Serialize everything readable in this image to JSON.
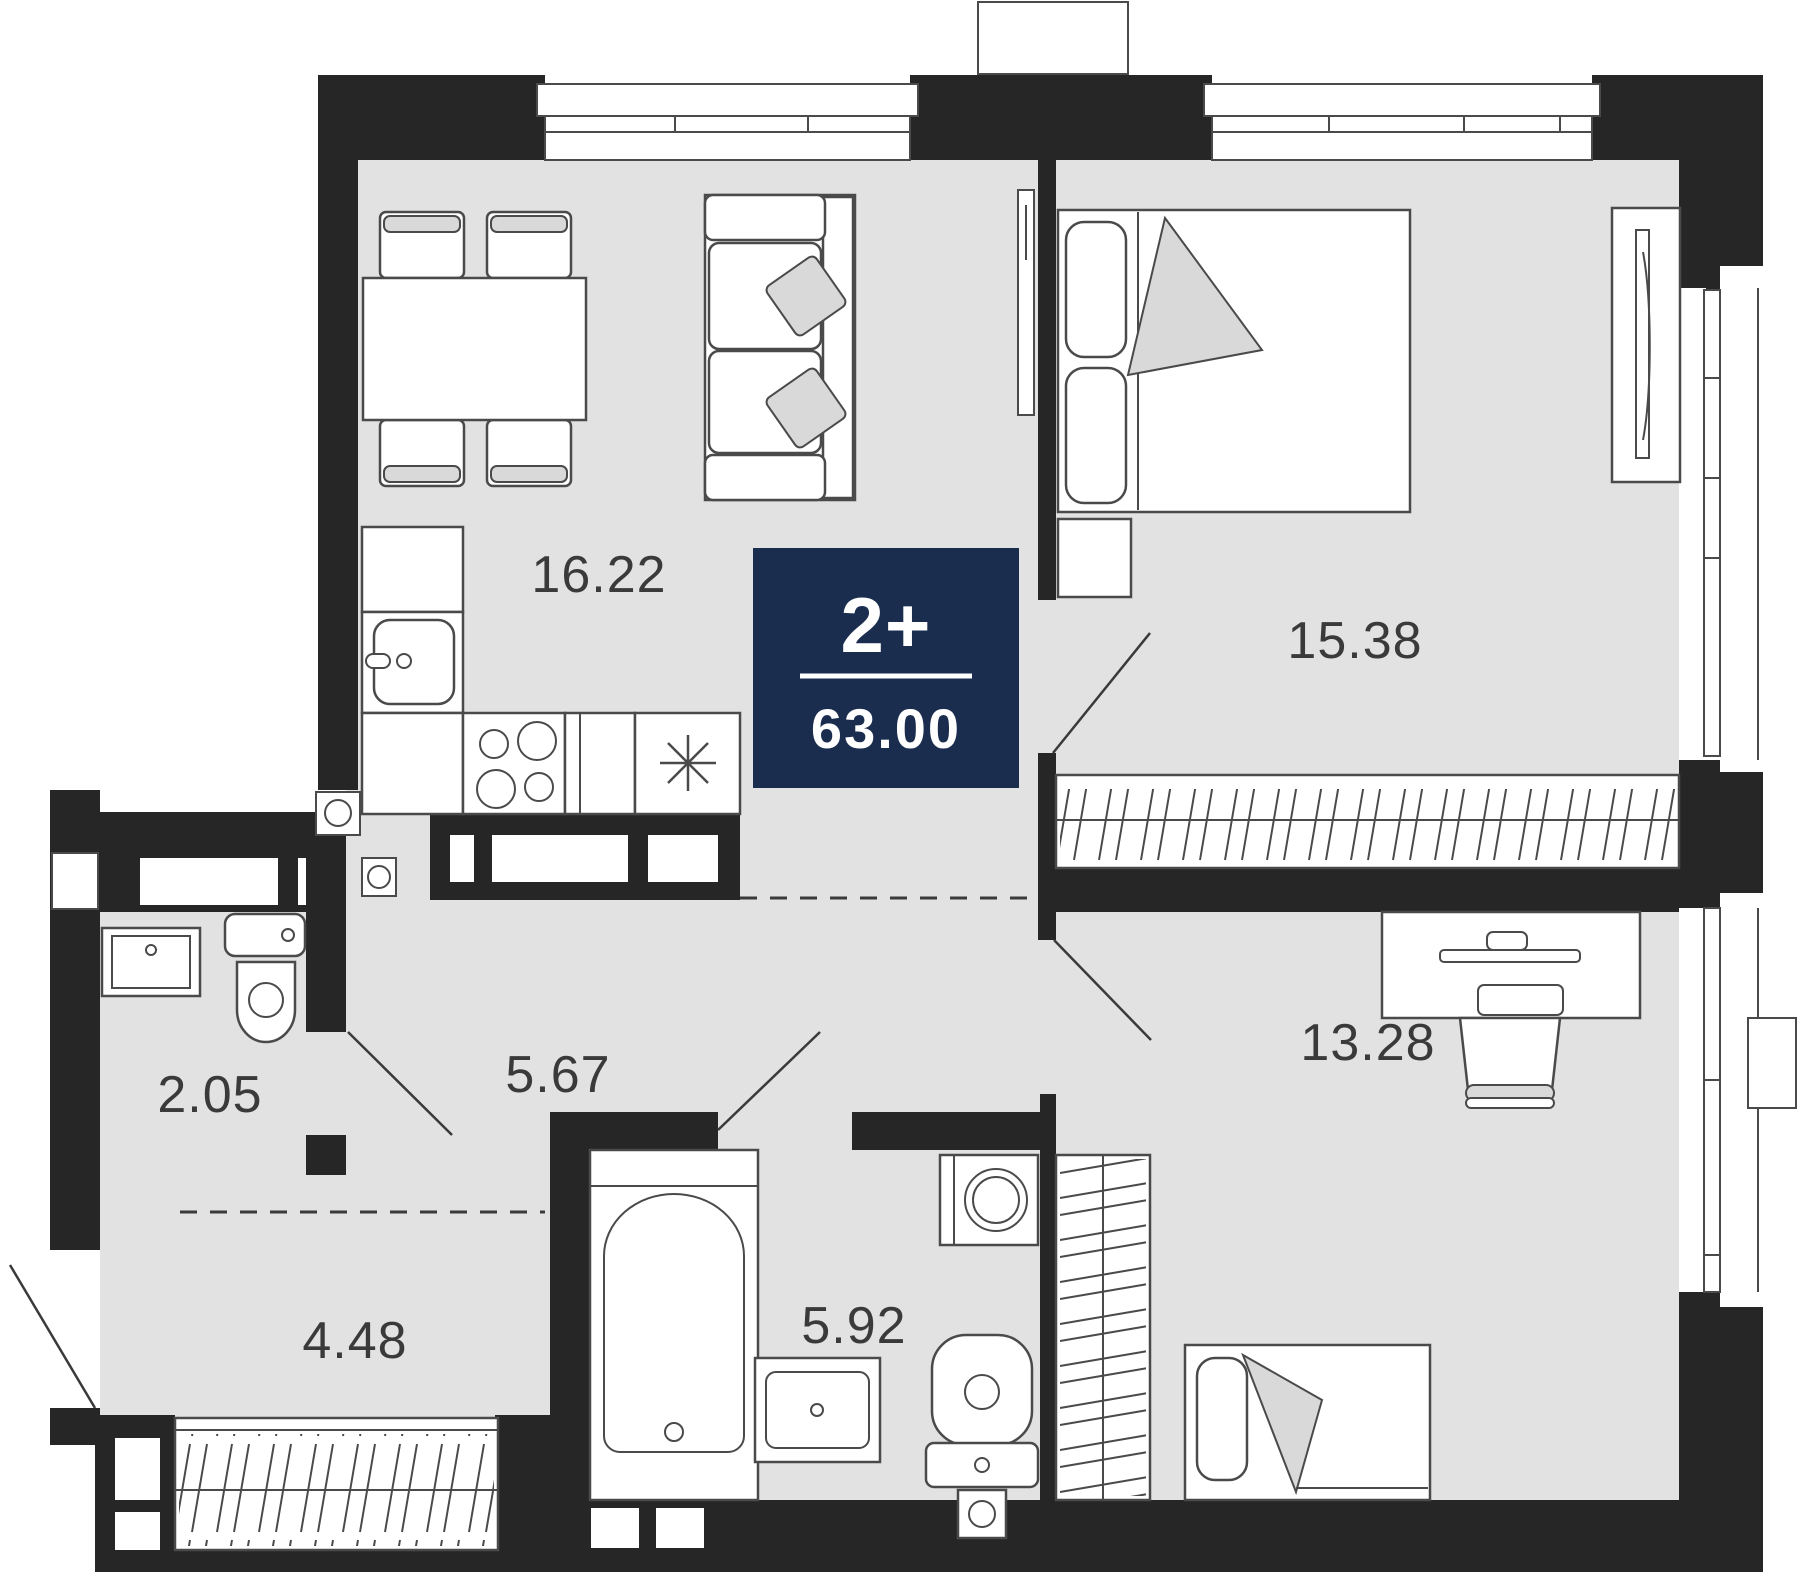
{
  "plan": {
    "title": "apartment-floor-plan",
    "badge": {
      "rooms_label": "2+",
      "total_area": "63.00",
      "background": "#1b2d4e",
      "text_color": "#ffffff"
    },
    "rooms": [
      {
        "id": "living-kitchen",
        "area": "16.22"
      },
      {
        "id": "bedroom",
        "area": "15.38"
      },
      {
        "id": "hallway",
        "area": "5.67"
      },
      {
        "id": "wc",
        "area": "2.05"
      },
      {
        "id": "entry-hall",
        "area": "4.48"
      },
      {
        "id": "bathroom",
        "area": "5.92"
      },
      {
        "id": "bedroom-2",
        "area": "13.28"
      }
    ],
    "colors": {
      "wall": "#262626",
      "floor": "#e2e2e2",
      "outline": "#4a4a4a",
      "soft_fill": "#d9d9d9",
      "label": "#3a3a3a"
    },
    "furniture": [
      "dining-table",
      "chairs",
      "sofa",
      "kitchen-counter",
      "sink",
      "stove",
      "fridge",
      "tv-panel",
      "double-bed",
      "nightstand",
      "mirror-wardrobe",
      "wardrobe",
      "desk",
      "desk-chair",
      "single-bed",
      "bathtub",
      "washing-machine",
      "washbasin",
      "toilet",
      "balcony",
      "windows"
    ]
  }
}
